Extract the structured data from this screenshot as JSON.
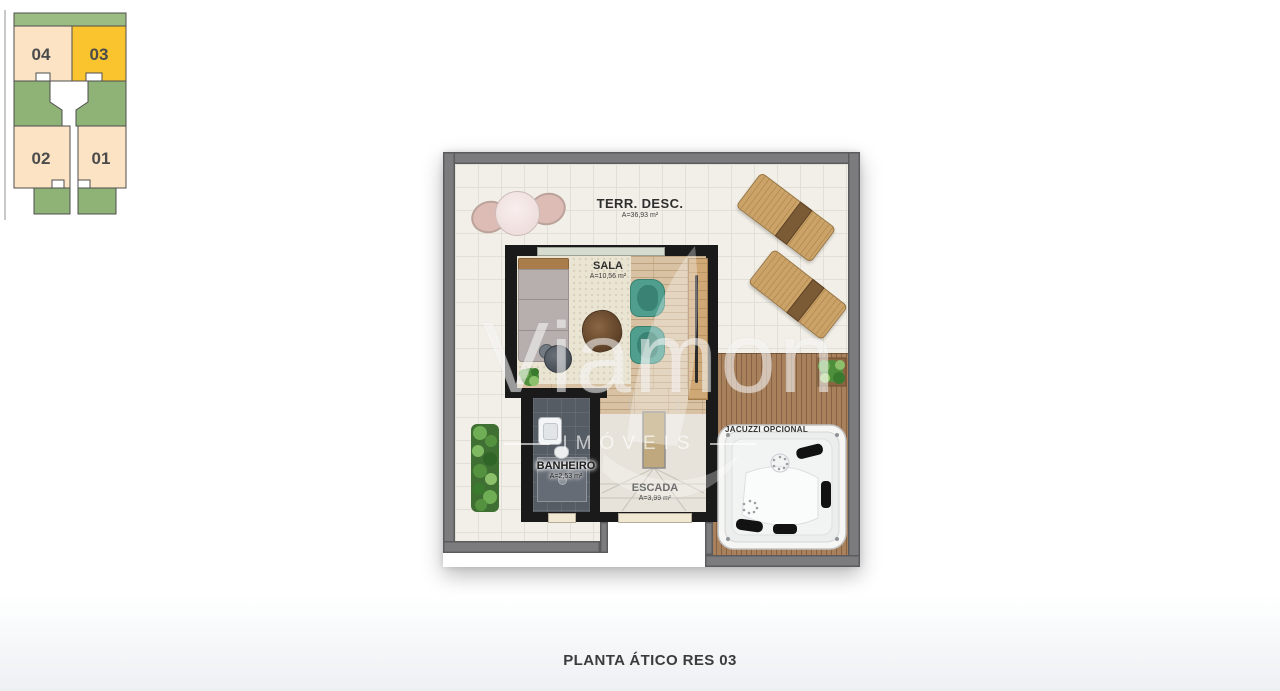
{
  "keyplan": {
    "units": [
      {
        "label": "04",
        "highlighted": false
      },
      {
        "label": "03",
        "highlighted": true
      },
      {
        "label": "02",
        "highlighted": false
      },
      {
        "label": "01",
        "highlighted": false
      }
    ]
  },
  "plan": {
    "rooms": {
      "terrace": {
        "name": "TERR. DESC.",
        "area": "A=36,93 m²"
      },
      "sala": {
        "name": "SALA",
        "area": "A=10,56 m²"
      },
      "banheiro": {
        "name": "BANHEIRO",
        "area": "A=2,53 m²"
      },
      "escada": {
        "name": "ESCADA",
        "area": "A=3,99 m²"
      },
      "jacuzzi": {
        "name": "JACUZZI OPCIONAL"
      }
    }
  },
  "watermark": {
    "brand": "Viamon",
    "sub": "IMÓVEIS"
  },
  "title": "PLANTA ÁTICO RES 03",
  "colors": {
    "highlight_unit": "#f9c42e",
    "unit_fill": "#fbe3c3",
    "keyplan_green": "#9bbc82",
    "deck_wood": "#a8805b",
    "wall_dark": "#1a1a1a",
    "wall_gray": "#7c7c7e",
    "teal_chair": "#4f9e8e",
    "tile": "#f2efe8"
  }
}
